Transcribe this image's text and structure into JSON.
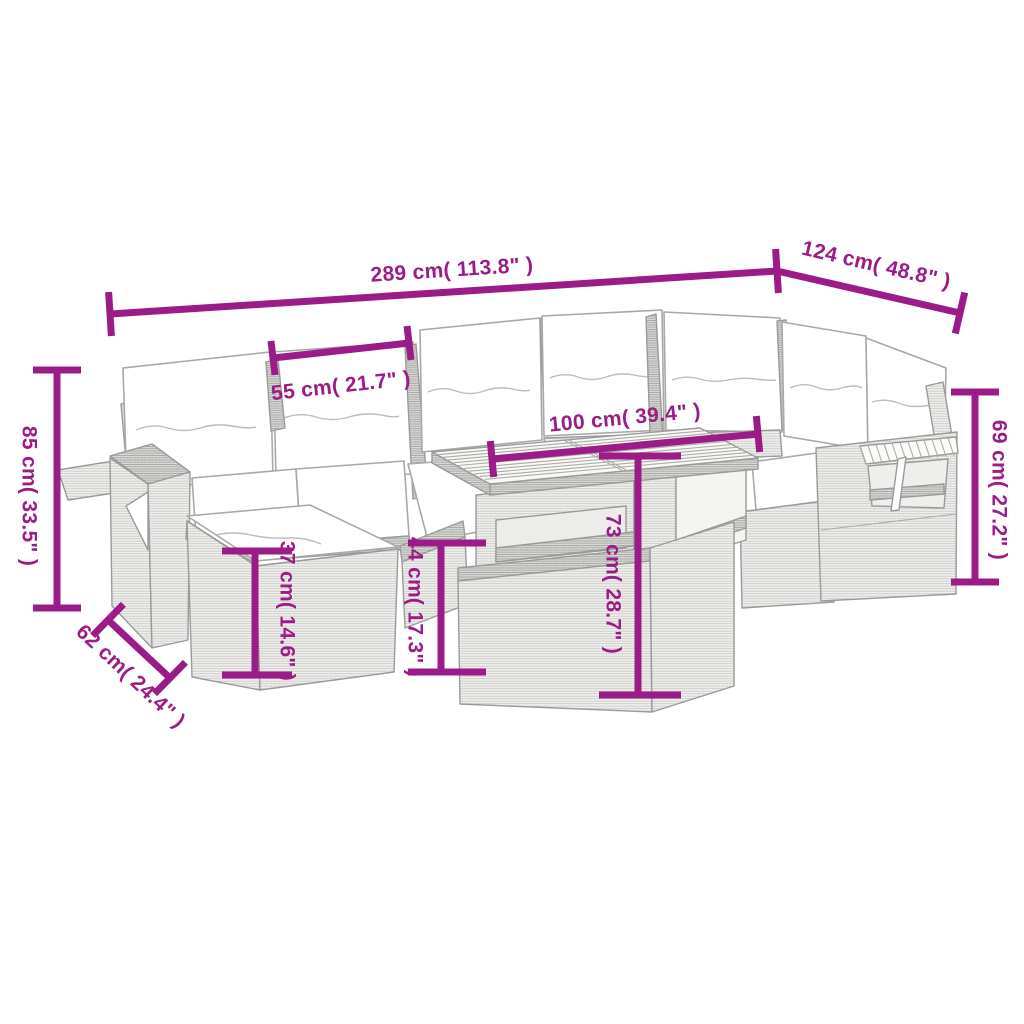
{
  "diagram": {
    "accent_color": "#9B1B87",
    "sketch_color": "#9a9a9a",
    "dims": {
      "total_width": "289 cm( 113.8\" )",
      "corner_depth": "124 cm( 48.8\" )",
      "seat_width": "55 cm( 21.7\" )",
      "table_width": "100 cm( 39.4\" )",
      "back_height": "85 cm( 33.5\" )",
      "arm_height": "69 cm( 27.2\" )",
      "ottoman_height": "37 cm( 14.6\" )",
      "seat_height": "44 cm( 17.3\" )",
      "table_height": "73 cm( 28.7\" )",
      "ottoman_depth": "62 cm( 24.4\" )"
    }
  }
}
